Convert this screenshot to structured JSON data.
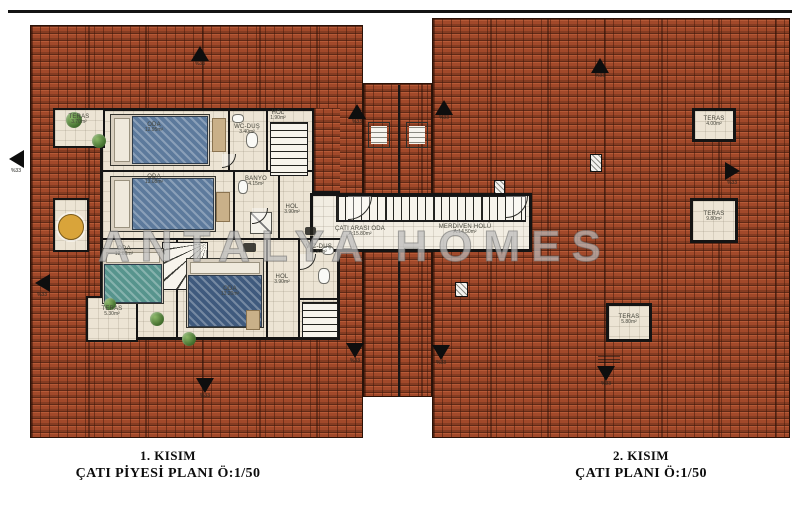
{
  "watermark": "ANTALYA HOMES",
  "slope": "%33",
  "captions": {
    "left": {
      "line1": "1. KISIM",
      "line2": "ÇATI PİYESİ PLANI Ö:1/50"
    },
    "right": {
      "line1": "2. KISIM",
      "line2": "ÇATI PLANI Ö:1/50"
    }
  },
  "labels": {
    "teras_tl": {
      "name": "TERAS",
      "area": "3.70m²"
    },
    "oda1": {
      "name": "ODA",
      "area": "12.95m²"
    },
    "wc1": {
      "name": "WC-DUŞ",
      "area": "3.40m²"
    },
    "hol1": {
      "name": "HOL",
      "area": "1.90m²"
    },
    "oda2": {
      "name": "ODA",
      "area": "13.08m²"
    },
    "banyo": {
      "name": "BANYO",
      "area": "4.15m²"
    },
    "hol_mid": {
      "name": "HOL",
      "area": "3.90m²"
    },
    "cati_arasi": {
      "name": "ÇATI ARASI ODA",
      "area": "A:15.80m²"
    },
    "merdiven": {
      "name": "MERDİVEN HOLÜ",
      "area": "A:14.50m²"
    },
    "oda3": {
      "name": "ODA",
      "area": "12.60m²"
    },
    "oda4": {
      "name": "ODA",
      "area": "13.20m²"
    },
    "hol2": {
      "name": "HOL",
      "area": "3.90m²"
    },
    "wc2": {
      "name": "WC-DUŞ",
      "area": "3.30m²"
    },
    "teras_bl": {
      "name": "TERAS",
      "area": "5.30m²"
    },
    "teras_r1": {
      "name": "TERAS",
      "area": "4.00m²"
    },
    "teras_r2": {
      "name": "TERAS",
      "area": "9.80m²"
    },
    "teras_r3": {
      "name": "TERAS",
      "area": "5.80m²"
    }
  },
  "colors": {
    "roof": "#a2492a",
    "wall": "#141414",
    "floor": "#ece4d4",
    "plant": "#44702f",
    "bed_blue": "#5d7a9c",
    "bed_teal": "#57948d",
    "bed_navy": "#3f5a7d"
  }
}
